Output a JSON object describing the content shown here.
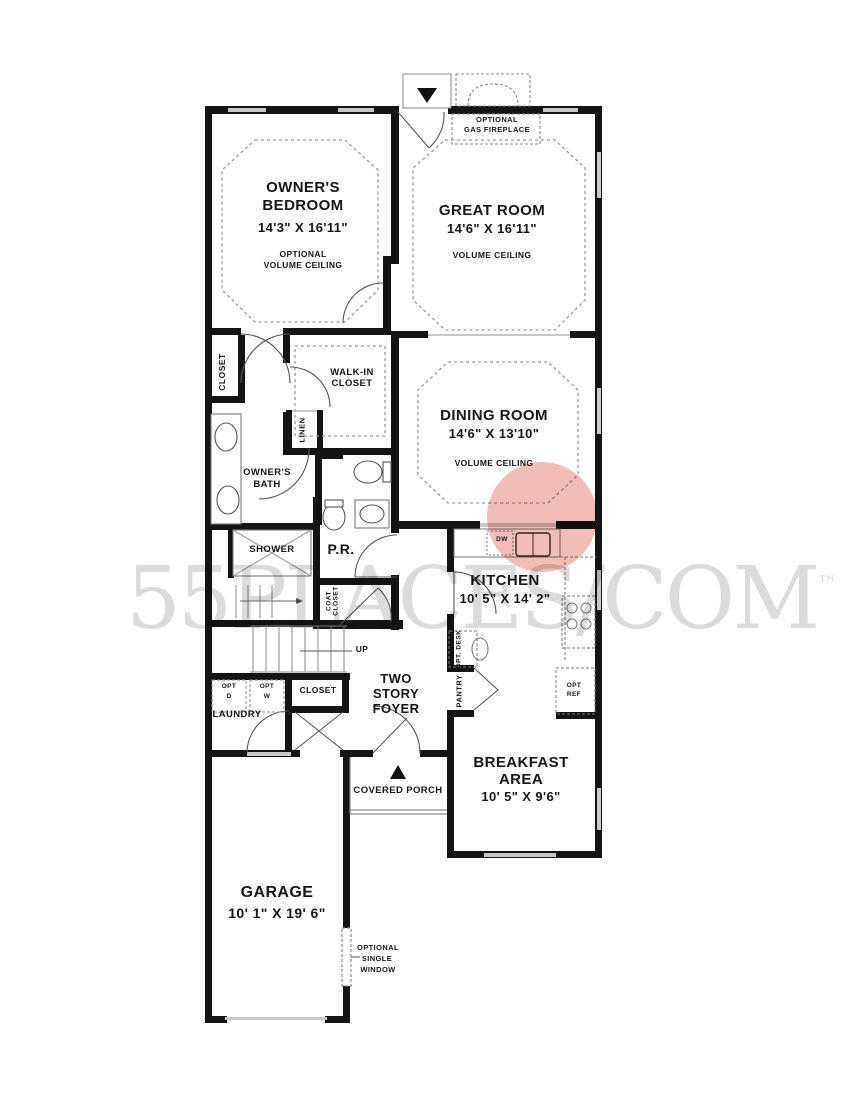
{
  "watermark": {
    "text_main": "55PLACES",
    "separator": "/",
    "text_domain": "COM",
    "trademark": "™",
    "circle_color": "#f0b0aa"
  },
  "rooms": {
    "owners_bedroom": {
      "name_line1": "OWNER'S",
      "name_line2": "BEDROOM",
      "dims": "14'3\" X 16'11\"",
      "note_line1": "OPTIONAL",
      "note_line2": "VOLUME CEILING"
    },
    "great_room": {
      "name": "GREAT ROOM",
      "dims": "14'6\" X 16'11\"",
      "note": "VOLUME CEILING"
    },
    "dining_room": {
      "name": "DINING ROOM",
      "dims": "14'6\" X 13'10\"",
      "note": "VOLUME CEILING"
    },
    "kitchen": {
      "name": "KITCHEN",
      "dims": "10' 5\" X 14' 2\""
    },
    "breakfast_area": {
      "name_line1": "BREAKFAST",
      "name_line2": "AREA",
      "dims": "10' 5\" X 9'6\""
    },
    "garage": {
      "name": "GARAGE",
      "dims": "10' 1\" X 19' 6\""
    },
    "foyer": {
      "line1": "TWO",
      "line2": "STORY",
      "line3": "FOYER"
    },
    "covered_porch": {
      "name": "COVERED PORCH"
    },
    "owners_bath": {
      "line1": "OWNER'S",
      "line2": "BATH"
    },
    "walk_in_closet": {
      "line1": "WALK-IN",
      "line2": "CLOSET"
    },
    "powder_room": {
      "name": "P.R."
    },
    "shower": {
      "name": "SHOWER"
    },
    "laundry": {
      "name": "LAUNDRY"
    }
  },
  "labels": {
    "fireplace_line1": "OPTIONAL",
    "fireplace_line2": "GAS FIREPLACE",
    "closet_bedroom": "CLOSET",
    "linen": "LINEN",
    "coat_closet_line1": "COAT",
    "coat_closet_line2": "CLOSET",
    "closet_foyer": "CLOSET",
    "up": "UP",
    "dw": "DW",
    "opt_desk": "OPT. DESK",
    "pantry": "PANTRY",
    "opt_ref_line1": "OPT",
    "opt_ref_line2": "REF",
    "opt_d_line1": "OPT",
    "opt_d_line2": "D",
    "opt_w_line1": "OPT",
    "opt_w_line2": "W",
    "opt_window_line1": "OPTIONAL",
    "opt_window_line2": "SINGLE",
    "opt_window_line3": "WINDOW"
  }
}
